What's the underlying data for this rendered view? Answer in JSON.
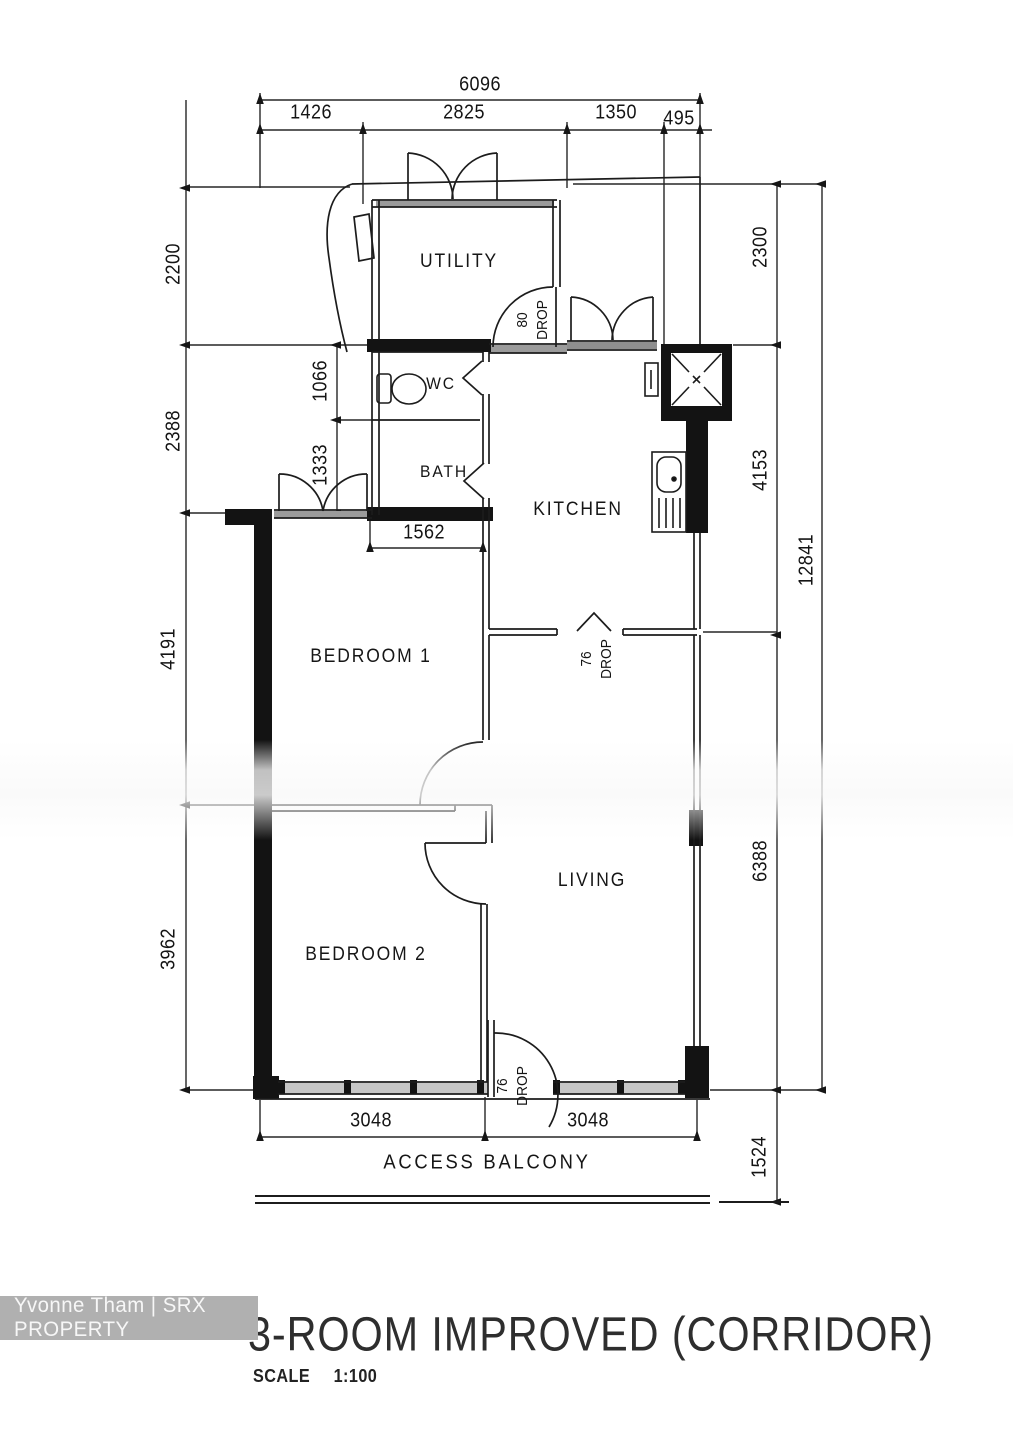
{
  "title": "3-ROOM IMPROVED (CORRIDOR)",
  "scale": {
    "label": "SCALE",
    "value": "1:100"
  },
  "watermark": "Yvonne Tham | SRX PROPERTY",
  "labels": {
    "utility": "UTILITY",
    "wc": "WC",
    "bath": "BATH",
    "kitchen": "KITCHEN",
    "bedroom1": "BEDROOM 1",
    "bedroom2": "BEDROOM 2",
    "living": "LIVING",
    "balcony": "ACCESS BALCONY"
  },
  "dims": {
    "top_total": "6096",
    "top_1": "1426",
    "top_2": "2825",
    "top_3": "1350",
    "top_4": "495",
    "left_1": "2200",
    "left_2": "2388",
    "wc_h": "1066",
    "bath_h": "1333",
    "bed1_h": "4191",
    "bed2_h": "3962",
    "bath_w": "1562",
    "right_1": "2300",
    "right_2": "4153",
    "right_total": "12841",
    "right_3": "6388",
    "right_4": "1524",
    "bottom_1": "3048",
    "bottom_2": "3048"
  },
  "drops": {
    "utility": {
      "num": "80",
      "word": "DROP"
    },
    "kitchen": {
      "num": "76",
      "word": "DROP"
    },
    "entrance": {
      "num": "76",
      "word": "DROP"
    }
  },
  "colors": {
    "line": "#1c1c1c",
    "watermark_bg": "#b0b0b0",
    "watermark_text": "#f7f7f7"
  }
}
